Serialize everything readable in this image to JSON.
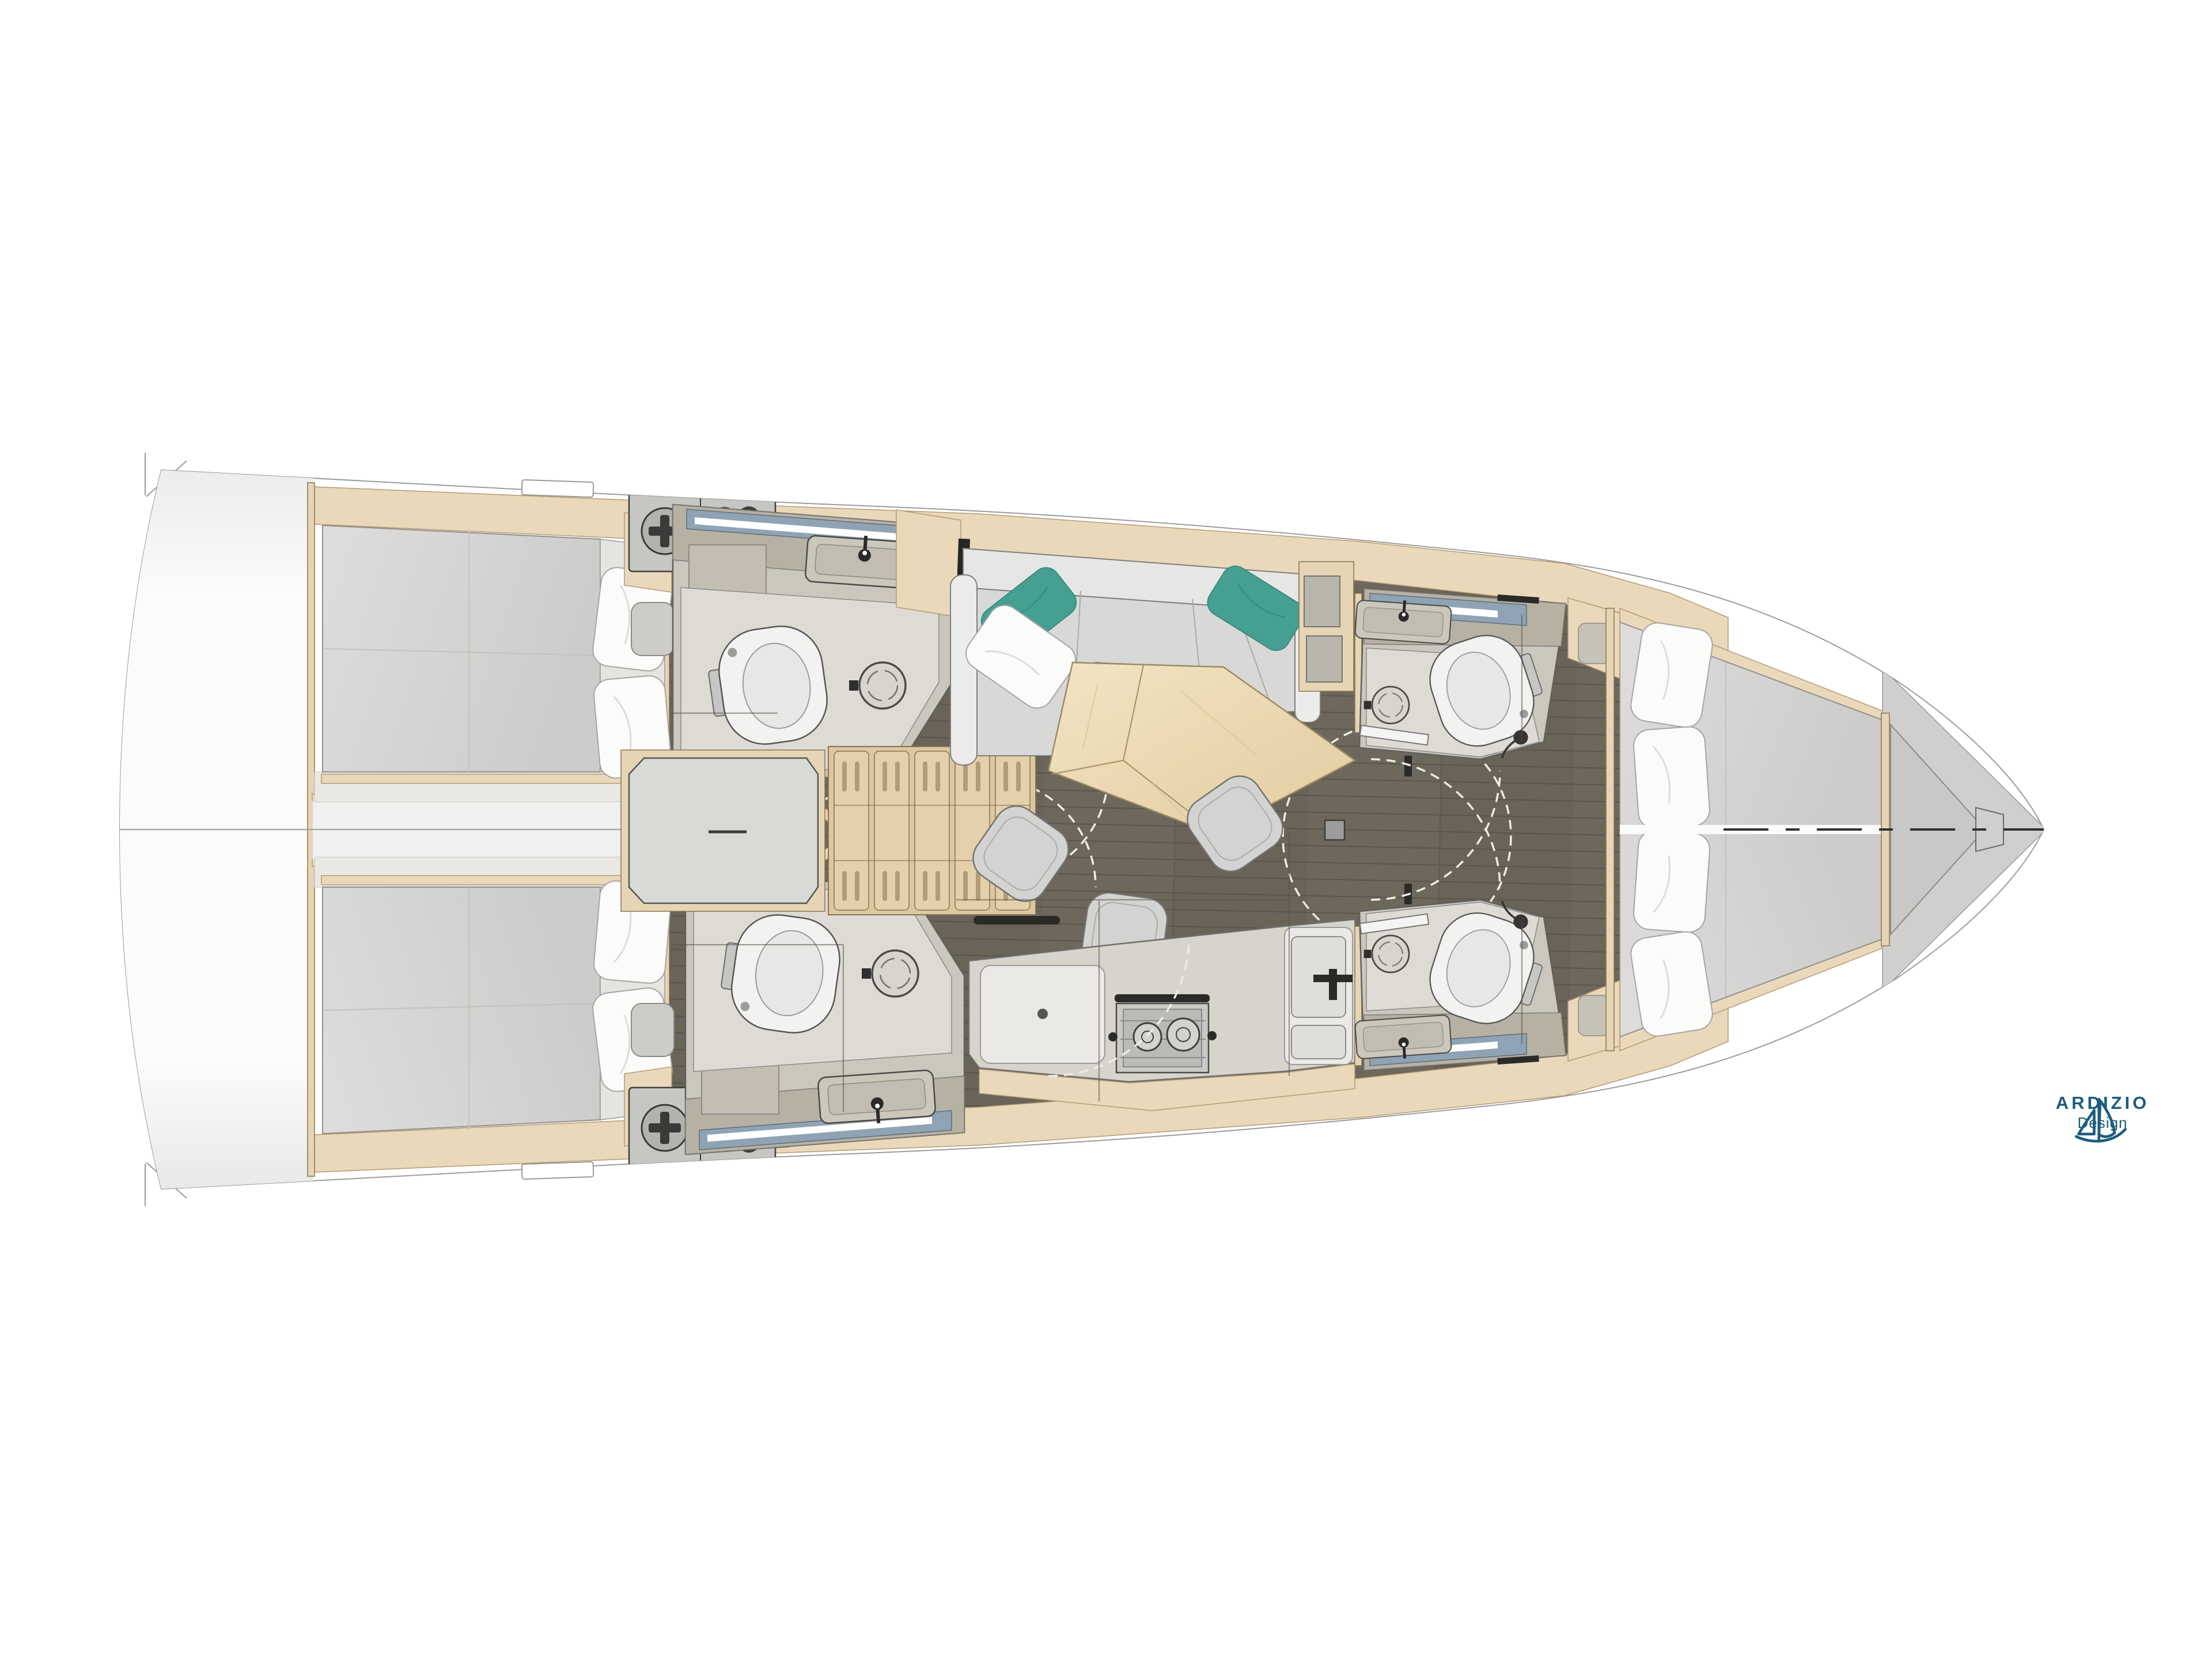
{
  "logo": {
    "brand": "ARDIZIO",
    "sub": "Design",
    "icon": "sailboat-icon",
    "color": "#1c5c7d"
  },
  "palette": {
    "background": "#ffffff",
    "hull_stroke": "#67676４",
    "inner_line": "#9c9c9a",
    "tan": "#e9d8ba",
    "tan_stroke": "#b49a74",
    "wood": "#e6d5b5",
    "wood_stroke": "#8a7350",
    "stairs_wood": "#dcc7a1",
    "stair_tread": "#e4d0aa",
    "floor": "#6e675c",
    "floor_line": "#55504a",
    "mattress": "#d7d6d4",
    "mattress_stroke": "#8f8f8d",
    "pillow": "#fbfbfa",
    "pillow_stroke": "#a5a5a3",
    "teal": "#45a092",
    "sofa": "#d8d8d6",
    "sofa_back": "#e6e6e4",
    "sofa_stroke": "#7e7e7c",
    "table": "#eddbb6",
    "table_stroke": "#9b8a64",
    "stool": "#d3d3d1",
    "stool_stroke": "#737371",
    "head_wall": "#cbc7bc",
    "head_floor": "#dedbd4",
    "head_counter": "#b7b1a4",
    "fixture": "#f2f2f0",
    "fixture_stroke": "#565654",
    "mirror_glass": "#8fa3b5",
    "panel": "#c6c6c3",
    "landing": "#d9d9d6",
    "locker": "#cfcfcd",
    "dark": "#2a2a28",
    "arc": "#efece4",
    "counter": "#d7d4cb",
    "counter_white": "#eae9e5",
    "logo": "#1c5c7d"
  }
}
